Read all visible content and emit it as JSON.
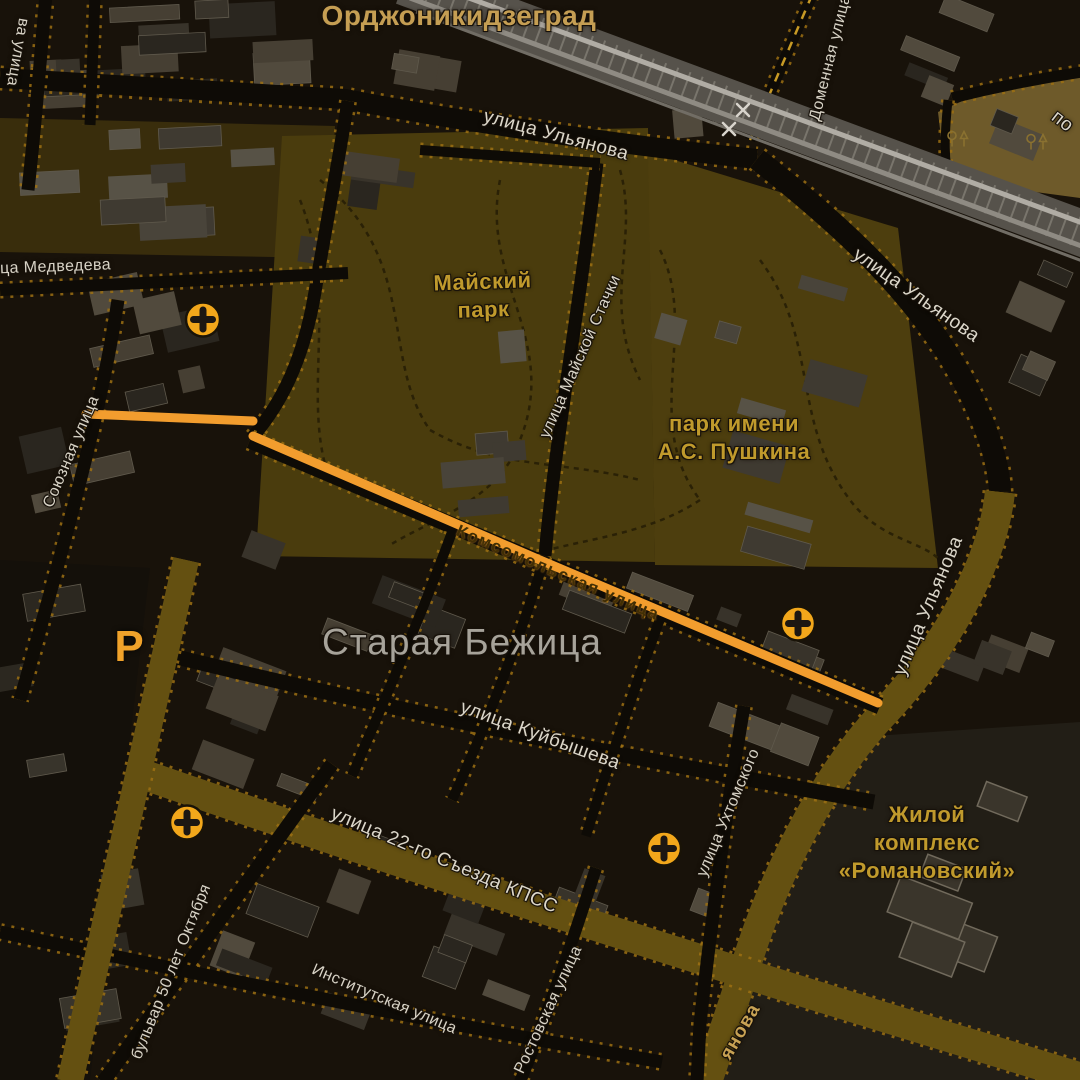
{
  "map": {
    "style": "night",
    "colors": {
      "background": "#18120a",
      "park_fill": "#4a3c0d",
      "industrial_tan": "#6e5a2a",
      "route_orange": "#f29d2e",
      "major_road_olive": "#645011",
      "road_dark": "#0e0b06",
      "road_edge_amber": "#9c7013",
      "railway_gray": "#aaa69e",
      "poi_orange": "#f2a71b",
      "street_text": "#d8d3c6",
      "park_text": "#c09a2c",
      "district_text": "#c59e53",
      "locality_text": "#a7a39a"
    },
    "labels": [
      {
        "name": "locality-ordzhonikidzegrad",
        "text": "Орджоникидзеград",
        "x": 459,
        "y": 16,
        "rot": 0,
        "variant": "district"
      },
      {
        "name": "street-ulyanova-north",
        "text": "улица Ульянова",
        "x": 556,
        "y": 136,
        "rot": 15,
        "variant": "street-lg"
      },
      {
        "name": "street-ulyanova-east",
        "text": "улица Ульянова",
        "x": 916,
        "y": 296,
        "rot": 35,
        "variant": "street-lg"
      },
      {
        "name": "street-ulyanova-south",
        "text": "улица Ульянова",
        "x": 929,
        "y": 606,
        "rot": -67,
        "variant": "street-lg"
      },
      {
        "name": "street-domennaya",
        "text": "Доменная улица",
        "x": 831,
        "y": 58,
        "rot": -76,
        "variant": "street"
      },
      {
        "name": "street-medvedeva",
        "text": "улица Медведева",
        "x": 42,
        "y": 268,
        "rot": -2,
        "variant": "street"
      },
      {
        "name": "street-soyuznaya",
        "text": "Союзная улица",
        "x": 72,
        "y": 452,
        "rot": -67,
        "variant": "street"
      },
      {
        "name": "park-maysky",
        "text": "Майский\nпарк",
        "x": 483,
        "y": 296,
        "rot": -2,
        "variant": "park"
      },
      {
        "name": "street-mayskoy-stachki",
        "text": "улица Майской Стачки",
        "x": 581,
        "y": 357,
        "rot": -66,
        "variant": "street"
      },
      {
        "name": "park-pushkina",
        "text": "парк имени\nА.С. Пушкина",
        "x": 734,
        "y": 438,
        "rot": 0,
        "variant": "park"
      },
      {
        "name": "street-komsomolskaya",
        "text": "Комсомольская улица",
        "x": 558,
        "y": 573,
        "rot": 23,
        "variant": "route-label"
      },
      {
        "name": "locality-staraya-bezhitsa",
        "text": "Старая Бежица",
        "x": 462,
        "y": 642,
        "rot": 0,
        "variant": "locality"
      },
      {
        "name": "street-kuybysheva",
        "text": "улица Куйбышева",
        "x": 540,
        "y": 736,
        "rot": 20,
        "variant": "street-lg"
      },
      {
        "name": "street-22-syezda-kpss",
        "text": "улица 22-го Съезда КПСС",
        "x": 444,
        "y": 861,
        "rot": 23,
        "variant": "street-lg"
      },
      {
        "name": "street-bulvar-50-let-oktyabrya",
        "text": "бульвар 50 лет Октября",
        "x": 172,
        "y": 972,
        "rot": -68,
        "variant": "street"
      },
      {
        "name": "street-institutskaya",
        "text": "Институтская улица",
        "x": 384,
        "y": 1000,
        "rot": 23,
        "variant": "street"
      },
      {
        "name": "street-rostovskaya",
        "text": "Ростовская улица",
        "x": 549,
        "y": 1010,
        "rot": -65,
        "variant": "street"
      },
      {
        "name": "street-ukhtomskogo",
        "text": "улица Ухтомского",
        "x": 729,
        "y": 813,
        "rot": -67,
        "variant": "street"
      },
      {
        "name": "complex-romanovsky",
        "text": "Жилой\nкомплекс\n«Романовский»",
        "x": 927,
        "y": 843,
        "rot": 0,
        "variant": "park"
      },
      {
        "name": "street-fragment-left",
        "text": "ва улица",
        "x": 17,
        "y": 52,
        "rot": 100,
        "variant": "street"
      },
      {
        "name": "street-fragment-po",
        "text": "по",
        "x": 1062,
        "y": 122,
        "rot": 38,
        "variant": "street-lg"
      },
      {
        "name": "road-fragment-ulyanova-bottom",
        "text": "янова",
        "x": 741,
        "y": 1032,
        "rot": -60,
        "variant": "road-gold"
      }
    ],
    "poi": {
      "medical_crosses": [
        {
          "x": 203,
          "y": 322
        },
        {
          "x": 798,
          "y": 626
        },
        {
          "x": 187,
          "y": 825
        },
        {
          "x": 664,
          "y": 851
        }
      ],
      "parking": {
        "x": 129,
        "y": 647,
        "label": "P"
      },
      "trees": [
        {
          "x": 958,
          "y": 141
        },
        {
          "x": 1037,
          "y": 144
        }
      ],
      "railway_crossings": [
        {
          "x": 743,
          "y": 110
        },
        {
          "x": 729,
          "y": 129
        }
      ]
    }
  }
}
